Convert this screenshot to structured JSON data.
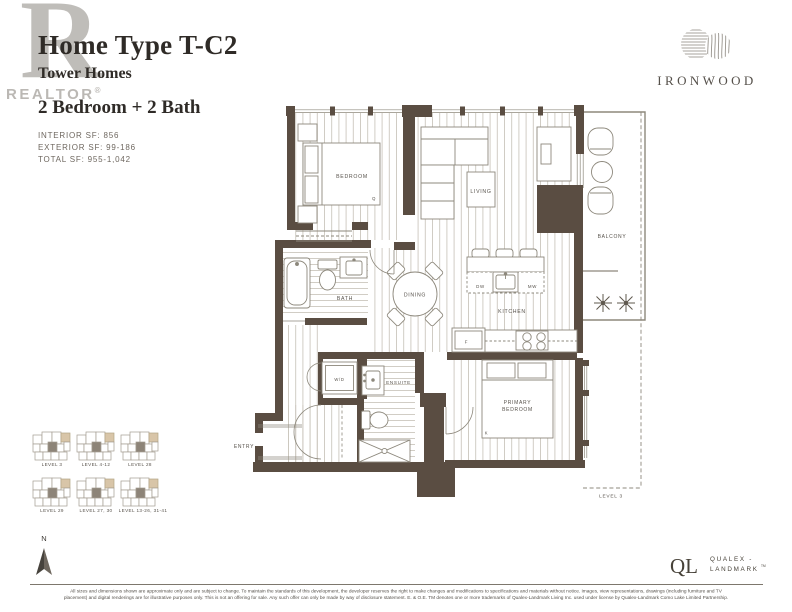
{
  "header": {
    "title": "Home Type T-C2",
    "subtitle": "Tower Homes",
    "config": "2 Bedroom + 2 Bath",
    "interior_sf": "INTERIOR SF: 856",
    "exterior_sf": "EXTERIOR SF: 99-186",
    "total_sf": "TOTAL SF: 955-1,042"
  },
  "watermark": {
    "letter": "R",
    "text": "REALTOR",
    "reg": "®"
  },
  "brand": {
    "name": "IRONWOOD"
  },
  "floorplan": {
    "rooms": {
      "bedroom": "BEDROOM",
      "queen": "Q",
      "living": "LIVING",
      "balcony": "BALCONY",
      "bath": "BATH",
      "dining": "DINING",
      "dishwasher": "DW",
      "microwave": "MW",
      "kitchen": "KITCHEN",
      "fridge": "F",
      "washer_dryer": "W/D",
      "ensuite": "ENSUITE",
      "entry": "ENTRY",
      "primary_line1": "PRIMARY",
      "primary_line2": "BEDROOM",
      "king": "K",
      "level3_terrace": "LEVEL 3"
    }
  },
  "keyplans": {
    "items": [
      {
        "label": "LEVEL 3"
      },
      {
        "label": "LEVEL 4-12"
      },
      {
        "label": "LEVEL 28"
      },
      {
        "label": "LEVEL 29"
      },
      {
        "label": "LEVEL 27, 30"
      },
      {
        "label": "LEVEL 13-26, 31-41"
      }
    ]
  },
  "compass": {
    "north": "N"
  },
  "developer": {
    "monogram": "QL",
    "line1": "QUALEX -",
    "line2": "LANDMARK",
    "tm": "TM"
  },
  "footer": {
    "line1": "All sizes and dimensions shown are approximate only and are subject to change. To maintain the standards of this development, the developer reserves the right to make changes and modifications to specifications and materials without notice. Images, view representations, drawings (including furniture and TV",
    "line2": "placement) and digital renderings are for illustrative purposes only. This is not an offering for sale. Any such offer can only be made by way of disclosure statement. E. & O.E. TM denotes one or more trademarks of Qualex-Landmark Living Inc. used under license by Qualex-Landmark Como Lake Limited Partnership."
  },
  "colors": {
    "wall": "#5a4d42",
    "floor_line": "#ccc7bf",
    "accent_tan": "#d8c5a8"
  }
}
